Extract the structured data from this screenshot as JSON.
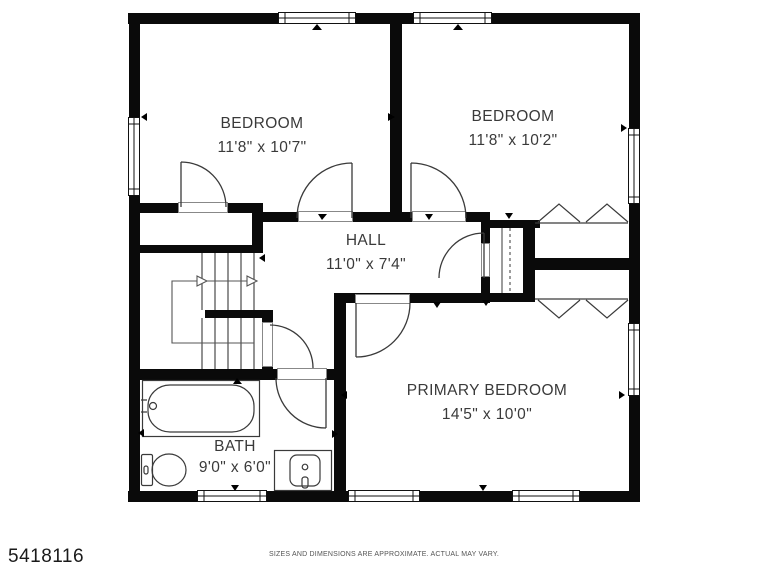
{
  "floor_plan": {
    "rooms": [
      {
        "name": "BEDROOM",
        "dimensions": "11'8\" x 10'7\""
      },
      {
        "name": "BEDROOM",
        "dimensions": "11'8\" x 10'2\""
      },
      {
        "name": "HALL",
        "dimensions": "11'0\" x 7'4\""
      },
      {
        "name": "PRIMARY BEDROOM",
        "dimensions": "14'5\" x 10'0\""
      },
      {
        "name": "BATH",
        "dimensions": "9'0\" x 6'0\""
      }
    ],
    "fixtures": [
      "bathtub",
      "toilet",
      "sink-vanity",
      "switchback-staircase",
      "linen-closet",
      "bifold-closet-doors"
    ],
    "footer": {
      "listing_id": "5418116",
      "disclaimer": "SIZES AND DIMENSIONS ARE APPROXIMATE. ACTUAL MAY VARY."
    },
    "colors": {
      "wall": "#0a0a0a",
      "background": "#ffffff",
      "linework": "#3a3a3a",
      "label_text": "#3a3a3a",
      "footer_text": "#555555"
    }
  }
}
